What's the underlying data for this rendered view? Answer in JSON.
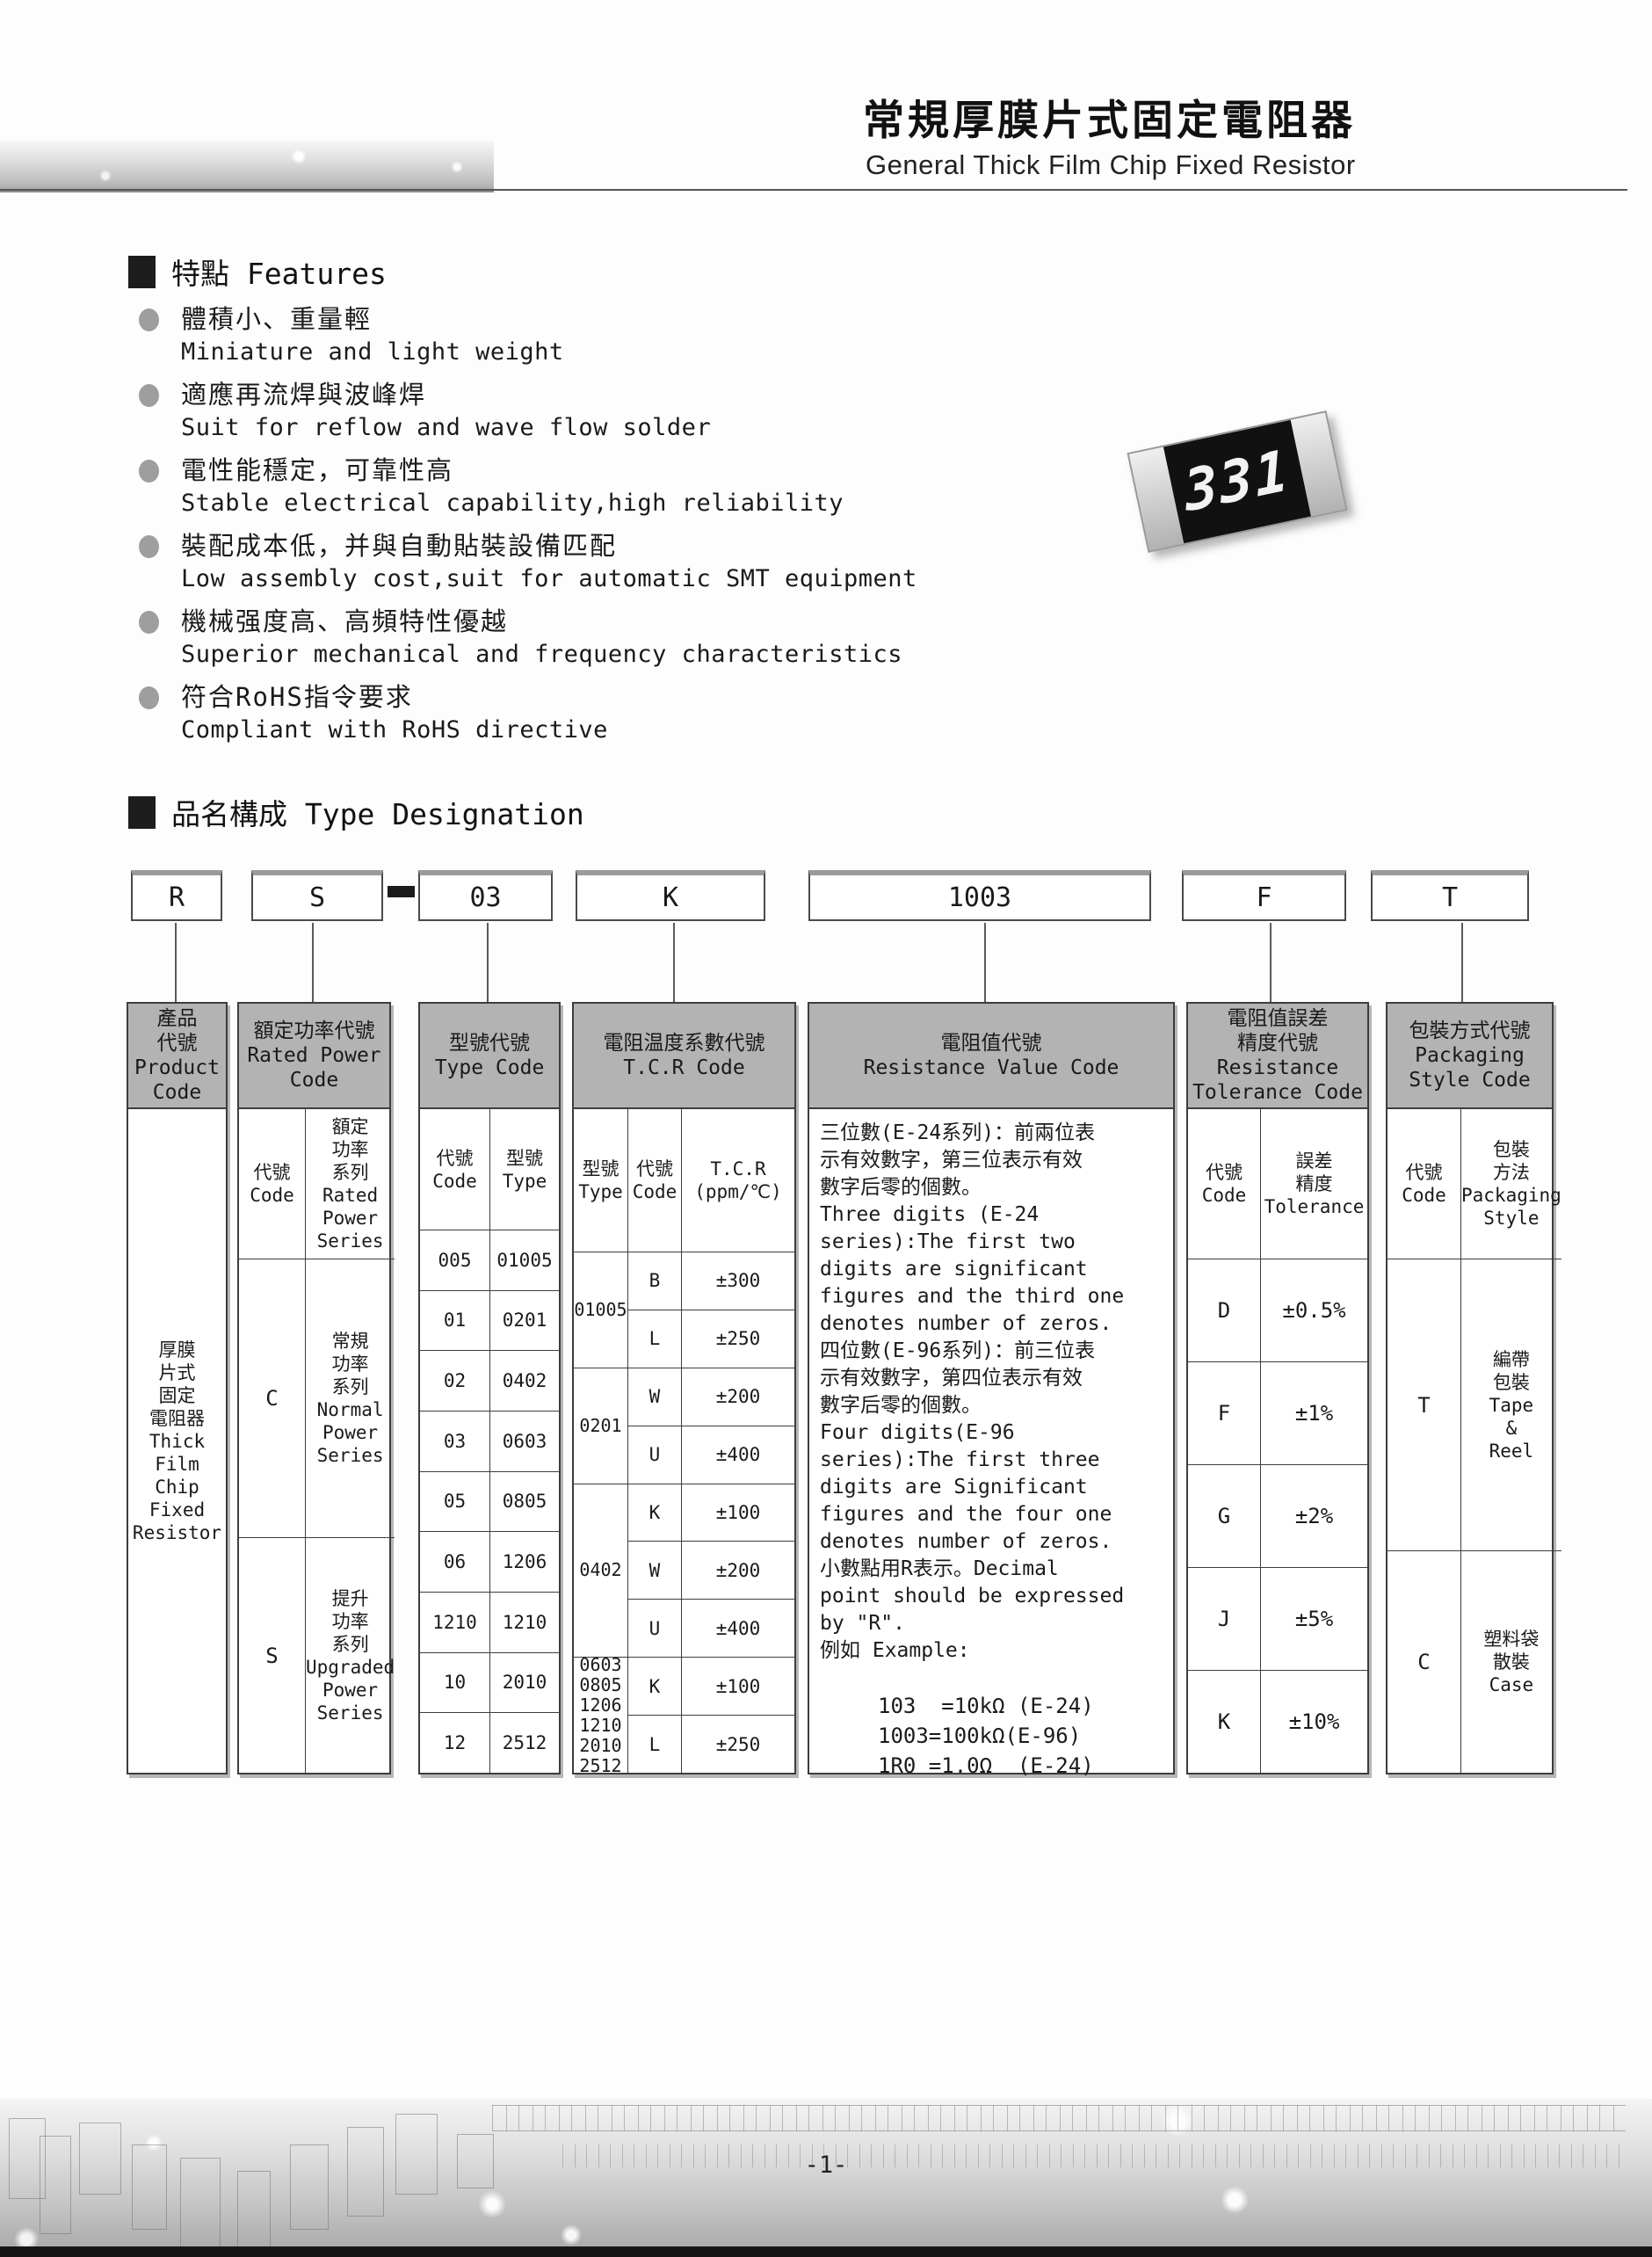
{
  "page": {
    "title_cn": "常規厚膜片式固定電阻器",
    "title_en": "General Thick Film Chip Fixed Resistor",
    "page_number": "-1-"
  },
  "features": {
    "heading": "特點 Features",
    "items": [
      {
        "cn": "體積小、重量輕",
        "en": "Miniature and light weight"
      },
      {
        "cn": "適應再流焊與波峰焊",
        "en": "Suit for reflow and wave flow solder"
      },
      {
        "cn": "電性能穩定，可靠性高",
        "en": "Stable electrical capability,high reliability"
      },
      {
        "cn": "裝配成本低，并與自動貼裝設備匹配",
        "en": "Low assembly cost,suit for automatic SMT equipment"
      },
      {
        "cn": "機械强度高、高頻特性優越",
        "en": "Superior mechanical and frequency characteristics"
      },
      {
        "cn": "符合RoHS指令要求",
        "en": "Compliant with RoHS directive"
      }
    ]
  },
  "resistor": {
    "marking": "331"
  },
  "designation": {
    "heading": "品名構成  Type Designation",
    "boxes": [
      "R",
      "S",
      "03",
      "K",
      "1003",
      "F",
      "T"
    ]
  },
  "table": {
    "product": {
      "header": "產品\n代號\nProduct\nCode",
      "body": "厚膜\n片式\n固定\n電阻器\nThick\nFilm\nChip\nFixed\nResistor"
    },
    "power": {
      "header": "額定功率代號\nRated Power\nCode",
      "code_label": "代號\nCode",
      "series_label": "額定\n功率\n系列\nRated\nPower\nSeries",
      "rows": [
        {
          "code": "C",
          "series": "常規\n功率\n系列\nNormal\nPower\nSeries"
        },
        {
          "code": "S",
          "series": "提升\n功率\n系列\nUpgraded\nPower\nSeries"
        }
      ]
    },
    "type": {
      "header": "型號代號\nType Code",
      "code_label": "代號\nCode",
      "type_label": "型號\nType",
      "rows": [
        {
          "code": "005",
          "type": "01005"
        },
        {
          "code": "01",
          "type": "0201"
        },
        {
          "code": "02",
          "type": "0402"
        },
        {
          "code": "03",
          "type": "0603"
        },
        {
          "code": "05",
          "type": "0805"
        },
        {
          "code": "06",
          "type": "1206"
        },
        {
          "code": "1210",
          "type": "1210"
        },
        {
          "code": "10",
          "type": "2010"
        },
        {
          "code": "12",
          "type": "2512"
        }
      ]
    },
    "tcr": {
      "header": "電阻温度系數代號\nT.C.R Code",
      "type_label": "型號\nType",
      "code_label": "代號\nCode",
      "tcr_label": "T.C.R\n(ppm/℃)",
      "group_types": [
        "01005",
        "0201",
        "0402",
        "0603\n0805\n1206\n1210\n2010\n2512"
      ],
      "rows": [
        {
          "code": "B",
          "value": "±300"
        },
        {
          "code": "L",
          "value": "±250"
        },
        {
          "code": "W",
          "value": "±200"
        },
        {
          "code": "U",
          "value": "±400"
        },
        {
          "code": "K",
          "value": "±100"
        },
        {
          "code": "W",
          "value": "±200"
        },
        {
          "code": "U",
          "value": "±400"
        },
        {
          "code": "K",
          "value": "±100"
        },
        {
          "code": "L",
          "value": "±250"
        }
      ]
    },
    "resistance": {
      "header": "電阻值代號\nResistance Value Code",
      "text": "三位數(E-24系列)：前兩位表\n示有效數字，第三位表示有效\n數字后零的個數。\nThree digits (E-24\nseries):The first two\ndigits are significant\nfigures and the third one\ndenotes number of zeros.\n四位數(E-96系列)：前三位表\n示有效數字，第四位表示有效\n數字后零的個數。\nFour digits(E-96\nseries):The first three\ndigits are Significant\nfigures and the four one\ndenotes number of zeros.\n小數點用R表示。Decimal\npoint should be expressed\nby \"R\".\n例如 Example:",
      "examples": "103  =10kΩ (E-24)\n1003=100kΩ(E-96)\n1R0 =1.0Ω  (E-24)"
    },
    "tolerance": {
      "header": "電阻值誤差\n精度代號\nResistance\nTolerance Code",
      "code_label": "代號\nCode",
      "tol_label": "誤差\n精度\nTolerance",
      "rows": [
        {
          "code": "D",
          "value": "±0.5%"
        },
        {
          "code": "F",
          "value": "±1%"
        },
        {
          "code": "G",
          "value": "±2%"
        },
        {
          "code": "J",
          "value": "±5%"
        },
        {
          "code": "K",
          "value": "±10%"
        }
      ]
    },
    "packaging": {
      "header": "包裝方式代號\nPackaging\nStyle Code",
      "code_label": "代號\nCode",
      "style_label": "包裝\n方法\nPackaging\nStyle",
      "rows": [
        {
          "code": "T",
          "style": "編帶\n包裝\nTape\n&\nReel"
        },
        {
          "code": "C",
          "style": "塑料袋\n散裝\nCase"
        }
      ]
    }
  },
  "colors": {
    "table_header_bg": "#b3b3b3",
    "border": "#3d3d3d",
    "bullet": "#9e9e9e"
  }
}
